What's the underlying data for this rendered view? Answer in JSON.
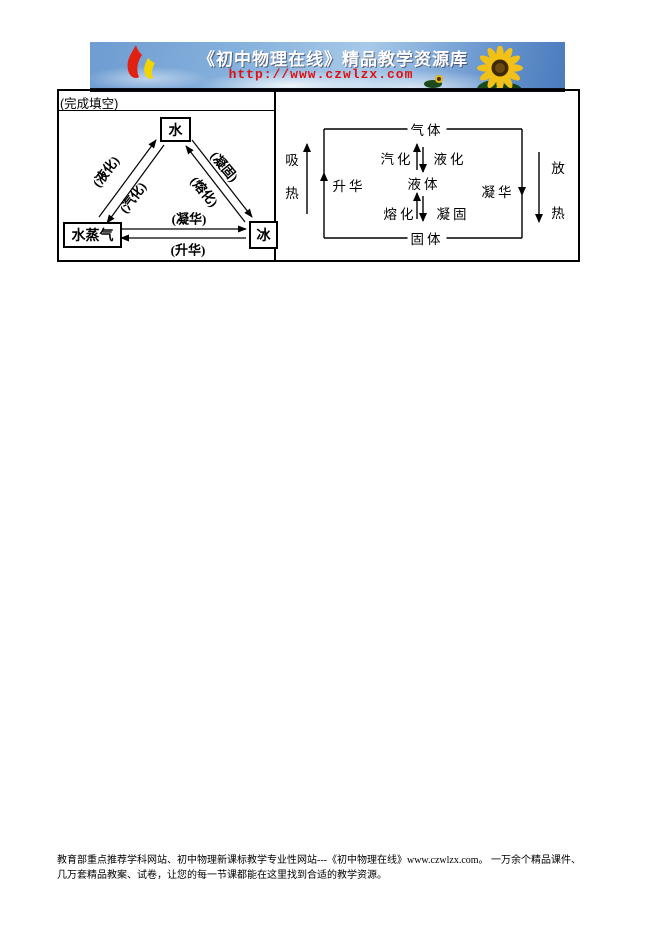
{
  "banner": {
    "title": "《初中物理在线》精品教学资源库",
    "url": "http://www.czwlzx.com",
    "icons": {
      "logo": "flame-logo",
      "right_decoration": "sunflower"
    },
    "colors": {
      "url_red": "#e01010",
      "sky_blue": "#6f9cd1",
      "petal_yellow": "#f2c118"
    }
  },
  "worksheet": {
    "prompt": "(完成填空)"
  },
  "triangle_diagram": {
    "nodes": {
      "water": "水",
      "vapor": "水蒸气",
      "ice": "冰"
    },
    "labels": {
      "liquefaction": "(液化)",
      "vaporization": "(汽化)",
      "solidification": "(凝固)",
      "melting": "(熔化)",
      "deposition": "(凝华)",
      "sublimation": "(升华)"
    }
  },
  "state_diagram": {
    "states": {
      "gas": "气体",
      "liquid": "液体",
      "solid": "固体"
    },
    "processes": {
      "vaporization": "汽化",
      "liquefaction": "液化",
      "melting": "熔化",
      "solidification": "凝固",
      "sublimation": "升华",
      "deposition": "凝华"
    },
    "heat": {
      "absorb": "吸热",
      "release": "放热"
    }
  },
  "footer": {
    "line1": "教育部重点推荐学科网站、初中物理新课标教学专业性网站---《初中物理在线》www.czwlzx.com。 一万余个精品课件、",
    "line2": "几万套精品教案、试卷，让您的每一节课都能在这里找到合适的教学资源。"
  }
}
